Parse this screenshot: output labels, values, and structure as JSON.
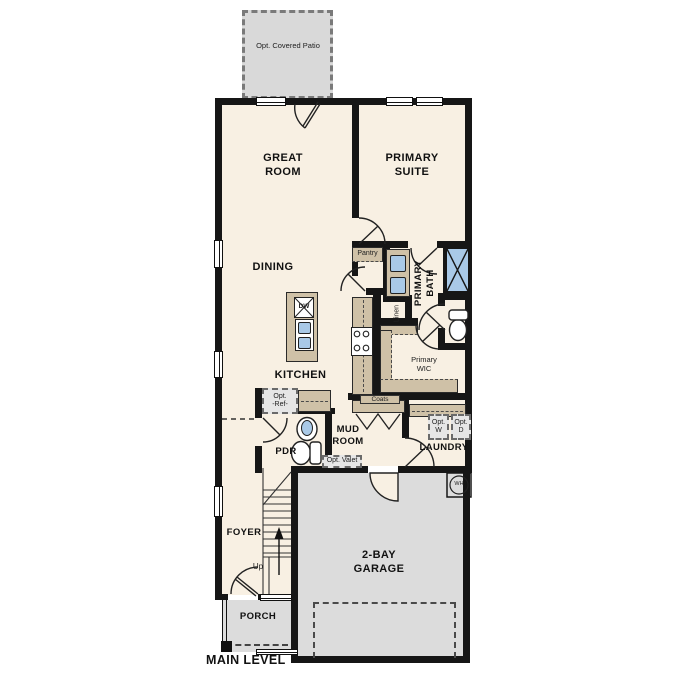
{
  "plan_title": "MAIN LEVEL",
  "rooms": {
    "great_room": "GREAT\nROOM",
    "primary_suite": "PRIMARY\nSUITE",
    "dining": "DINING",
    "kitchen": "KITCHEN",
    "primary_bath": "PRIMARY\nBATH",
    "pantry": "Pantry",
    "linen": "Linen",
    "primary_wic": "Primary\nWIC",
    "mud_room": "MUD\nROOM",
    "laundry": "LAUNDRY",
    "pdr": "PDR",
    "foyer": "FOYER",
    "garage": "2-BAY\nGARAGE",
    "porch": "PORCH"
  },
  "annotations": {
    "opt_covered_patio": "Opt. Covered Patio",
    "opt_ref": "Opt.\n-Ref-",
    "opt_washer": "Opt.\nW",
    "opt_dryer": "Opt.\nD",
    "opt_valet": "Opt. Valet",
    "coats": "Coats",
    "up": "Up",
    "water_heater": "WH",
    "dishwasher": "DW"
  },
  "colors": {
    "floor": "#f8f0e3",
    "garage_floor": "#dcdcdc",
    "patio_floor": "#d9d9d9",
    "counter": "#cfc1a7",
    "fixture_blue": "#a9c9e7",
    "wall": "#161616"
  }
}
